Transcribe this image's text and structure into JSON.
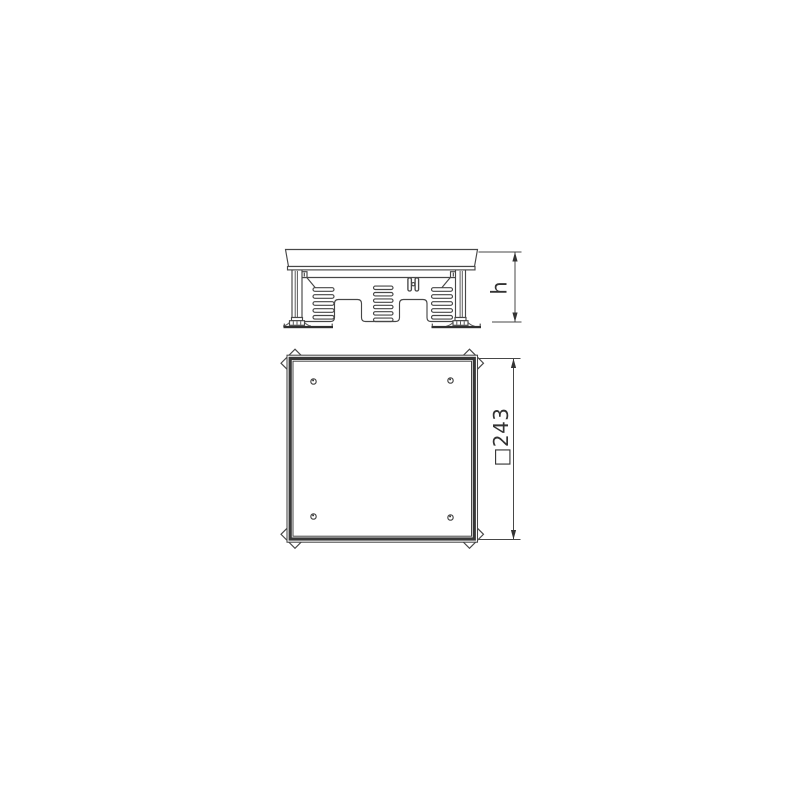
{
  "canvas": {
    "background": "#ffffff"
  },
  "colors": {
    "line": "#474747",
    "dark_fill": "#2f2f2f",
    "frame_band": "#383838",
    "text": "#333333"
  },
  "dimensions": {
    "height_label": "h",
    "square_label": "□243"
  }
}
